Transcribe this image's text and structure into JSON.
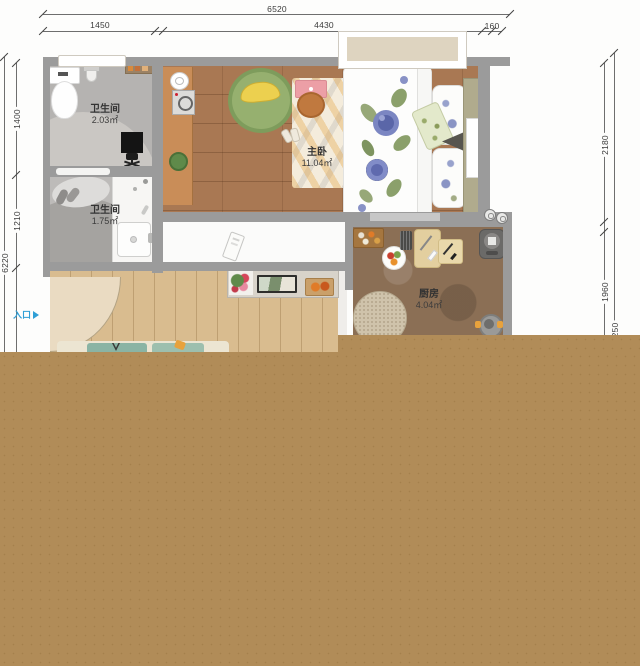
{
  "dimensions": {
    "top": {
      "total": "6520",
      "seg1": "1450",
      "seg2": "4430",
      "seg3": "160"
    },
    "left": {
      "total": "6220",
      "seg1": "1400",
      "seg2": "1210"
    },
    "right": {
      "seg1": "2180",
      "seg2": "1960",
      "outer_partial": "250"
    }
  },
  "rooms": {
    "bathroom1": {
      "name": "卫生间",
      "area": "2.03㎡"
    },
    "bathroom2": {
      "name": "卫生间",
      "area": "1.75㎡"
    },
    "bedroom": {
      "name": "主卧",
      "area": "11.04㎡"
    },
    "kitchen": {
      "name": "厨房",
      "area": "4.04㎡"
    }
  },
  "labels": {
    "entrance": "入口"
  },
  "colors": {
    "tan_overlay": "#b18c58",
    "wall_grey": "#9b9b9b",
    "entrance_blue": "#2f9fd6",
    "bedroom_wood": "#a97853",
    "living_wood": "#d9bc8f",
    "kitchen_floor": "#8b6f55",
    "bath_tile": "#b5b3b1",
    "window_fill": "#ded4c0"
  }
}
